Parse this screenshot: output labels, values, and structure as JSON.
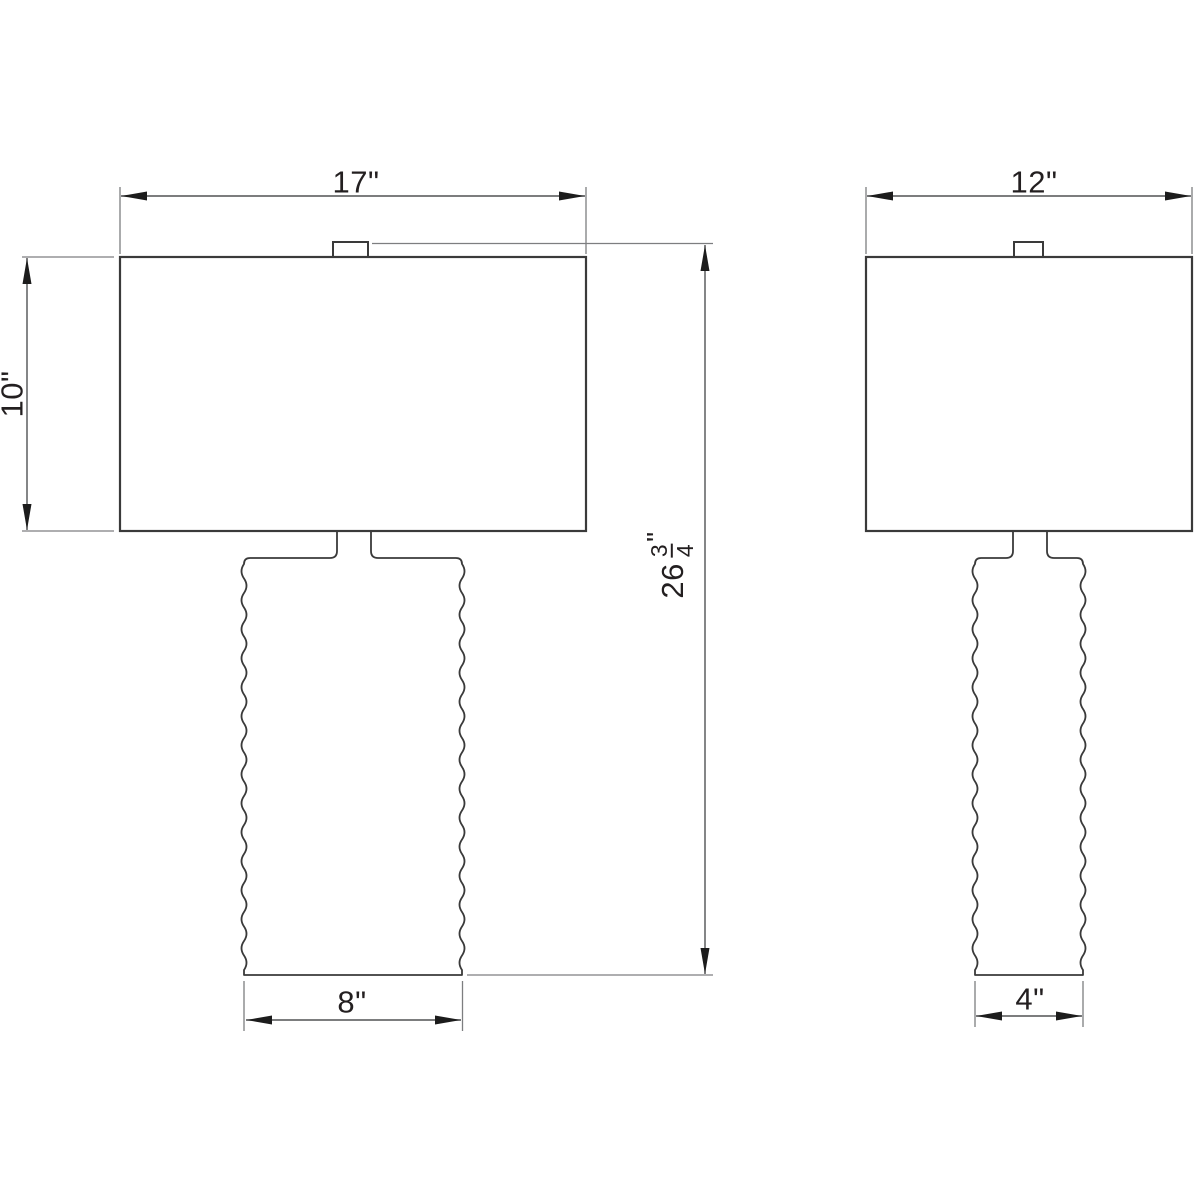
{
  "drawing": {
    "type": "technical-dimension-drawing",
    "subject": "table lamp elevations",
    "colors": {
      "background": "#ffffff",
      "object_line": "#3a3a3a",
      "dimension_line": "#515254",
      "extension_line": "#7d7e80",
      "arrow": "#1c1c1c",
      "text": "#231f20"
    },
    "front_view": {
      "shade_width": "17\"",
      "shade_height": "10\"",
      "base_width": "8\"",
      "overall_height": {
        "whole": "26",
        "numerator": "3",
        "denominator": "4",
        "unit": "\""
      }
    },
    "side_view": {
      "shade_width": "12\"",
      "base_width": "4\""
    }
  }
}
